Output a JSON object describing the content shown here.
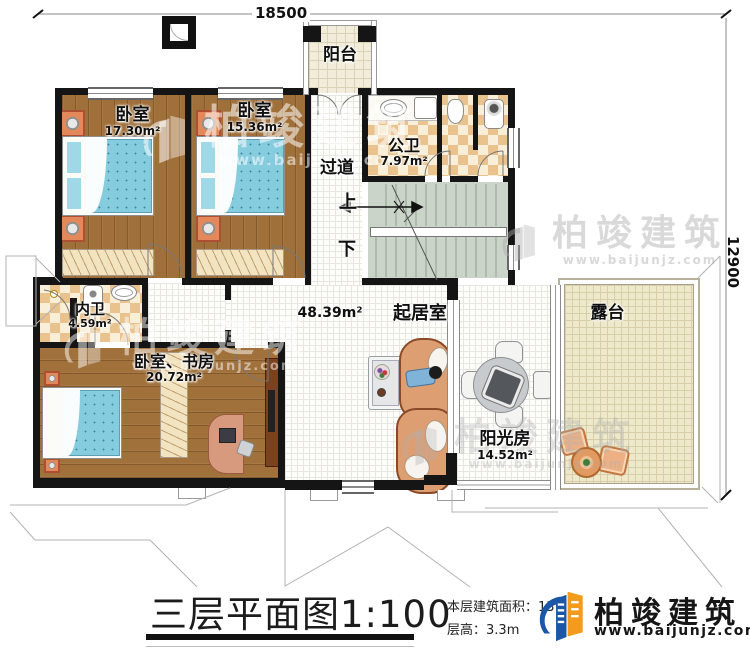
{
  "title": {
    "main": "三层平面图",
    "scale": "1:100"
  },
  "dimensions": {
    "width_mm": "18500",
    "height_mm": "12900"
  },
  "rooms": [
    {
      "name": "阳台",
      "area": ""
    },
    {
      "name": "卧室",
      "area": "17.30m²"
    },
    {
      "name": "卧室",
      "area": "15.36m²"
    },
    {
      "name": "公卫",
      "area": "7.97m²"
    },
    {
      "name": "过道",
      "area": ""
    },
    {
      "name": "内卫",
      "area": "4.59m²"
    },
    {
      "name": "卧室、书房",
      "area": "20.72m²"
    },
    {
      "name": "起居室",
      "area": "48.39m²"
    },
    {
      "name": "阳光房",
      "area": "14.52m²"
    },
    {
      "name": "露台",
      "area": ""
    }
  ],
  "stairs": {
    "up": "上",
    "down": "下"
  },
  "footer": {
    "area_label": "本层建筑面积：",
    "area_value": "137.2",
    "height_label": "层高：",
    "height_value": "3.3m"
  },
  "brand": {
    "name": "柏竣建筑",
    "url": "www.baijunjz.com"
  },
  "watermark": {
    "name": "柏竣建筑",
    "url": "www.baijunjz.com"
  },
  "colors": {
    "wall": "#151515",
    "brand_blue": "#1b57a6",
    "brand_orange": "#f29b1d"
  }
}
